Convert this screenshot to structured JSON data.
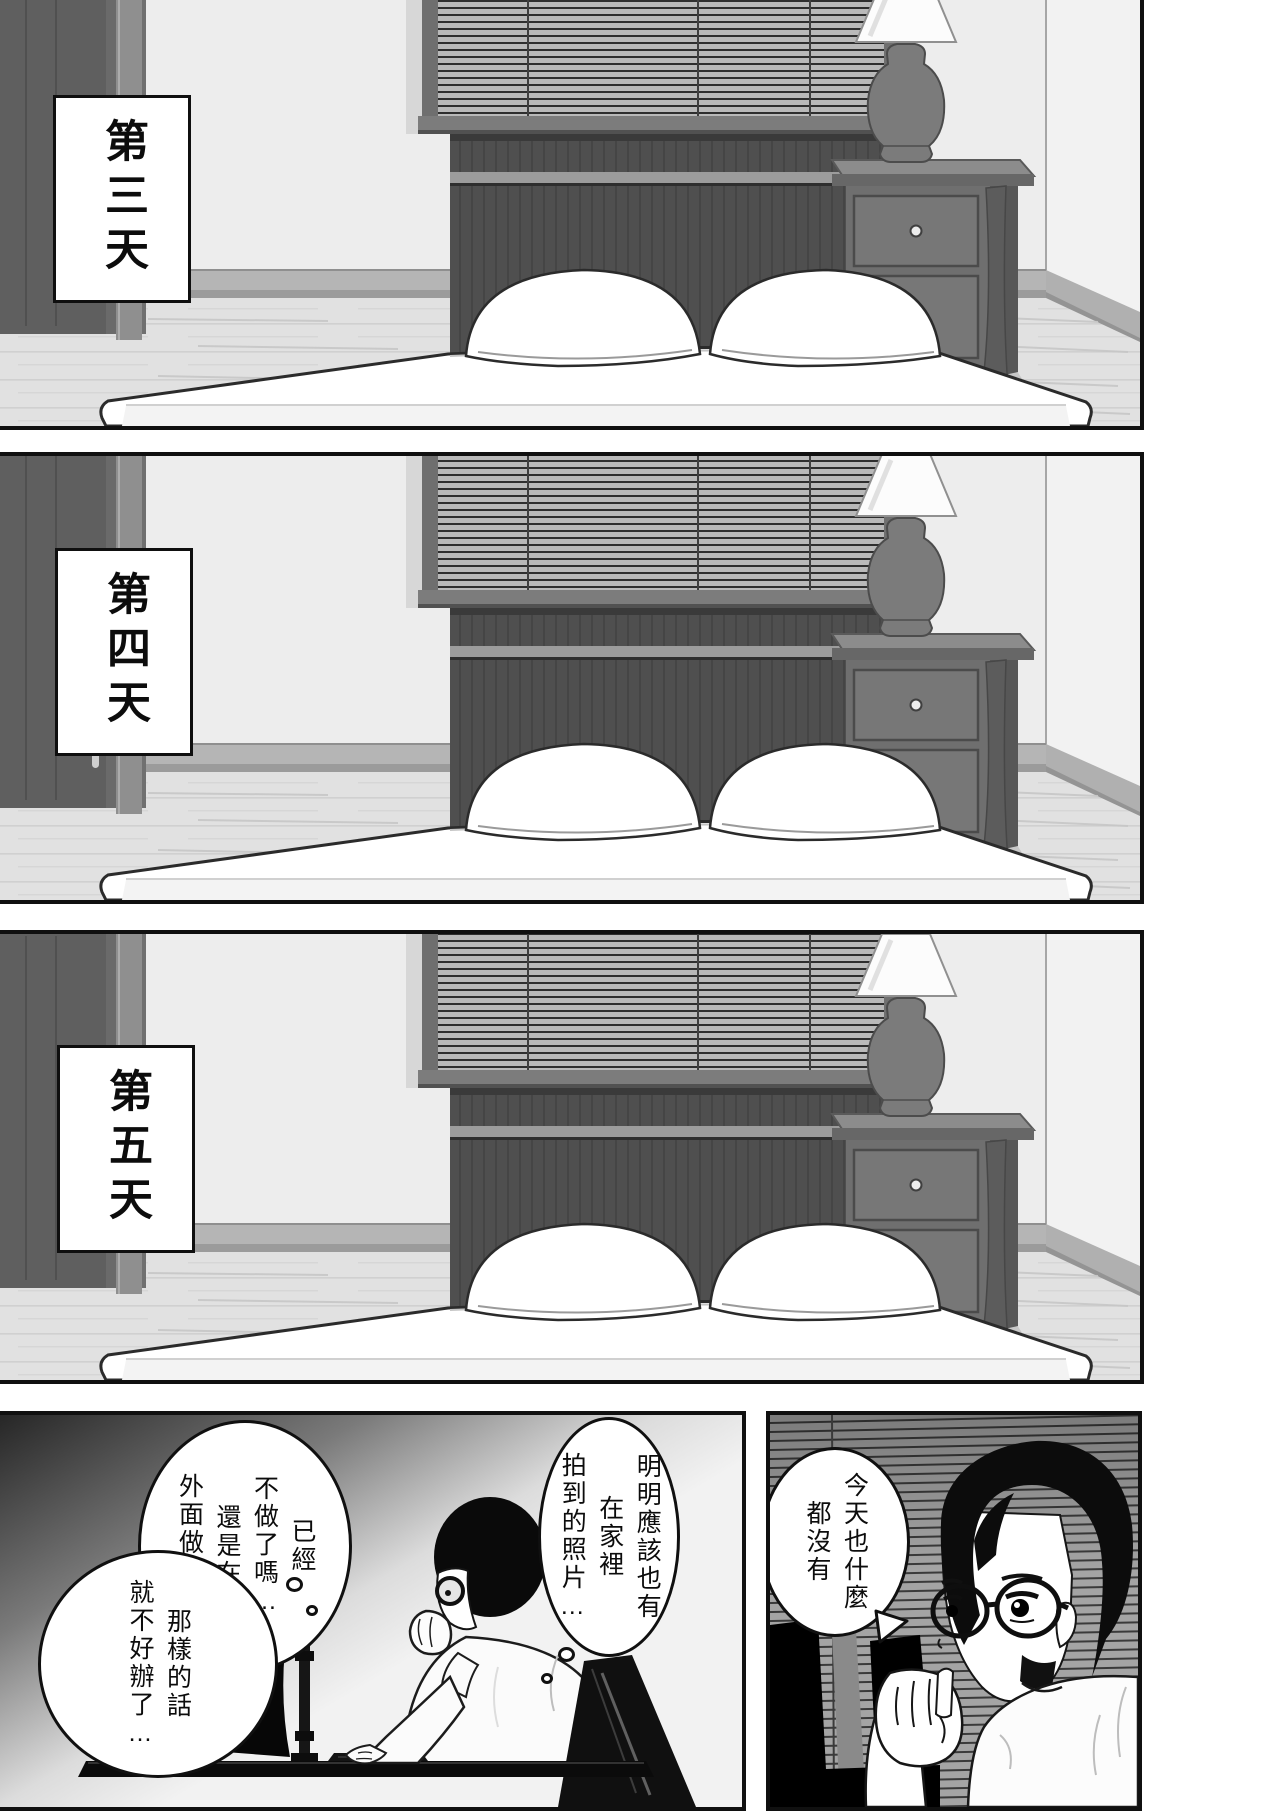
{
  "panels": [
    {
      "id": "day3",
      "day_label": "第三天"
    },
    {
      "id": "day4",
      "day_label": "第四天"
    },
    {
      "id": "day5",
      "day_label": "第五天"
    }
  ],
  "computer_panel": {
    "thought_photos": "明明應該也有\n在家裡\n拍到的照片…",
    "thought_doubt": "已經\n不做了嗎…\n還是在\n外面做……",
    "thought_trouble": "那樣的話\n就不好辦了…"
  },
  "closeup_panel": {
    "speech_today": "今天也什麼\n都沒有"
  },
  "colors": {
    "ink": "#101010",
    "paper": "#ffffff",
    "wall": "#ededed",
    "furniture_wood": "#6f6f6f",
    "headboard": "#4f4f4f",
    "blind_slat": "#b9b9b9",
    "closeup_blind": "#a4a4a4"
  }
}
